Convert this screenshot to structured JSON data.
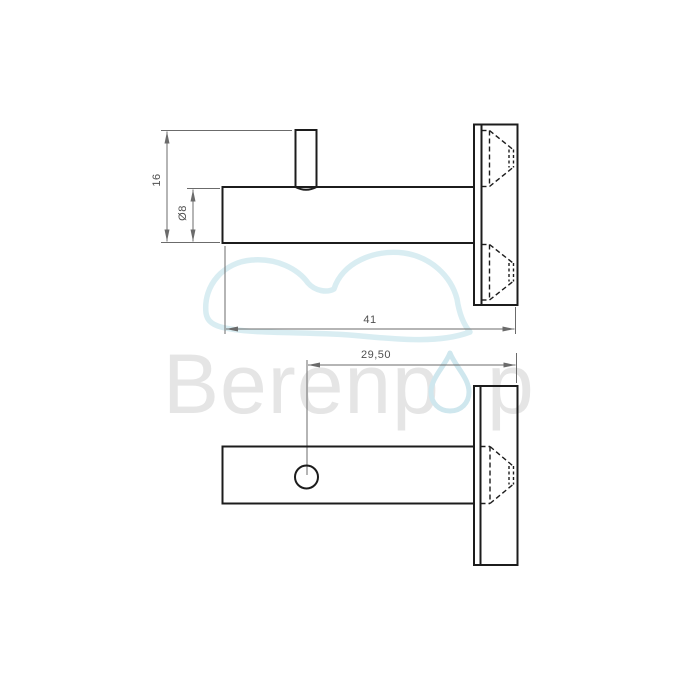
{
  "drawing": {
    "type": "technical-dimension-drawing",
    "colors": {
      "background": "#ffffff",
      "edge_line": "#1c1c1c",
      "dimension_line": "#6b6b6b",
      "dimension_text": "#4f4f4f",
      "watermark_text": "#e5e5e5",
      "logo_cloud": "#d9edf2",
      "logo_droplet": "#cfe7ee"
    },
    "side_view": {
      "name": "side view (hook with mounting plate)",
      "dim_overall_height": "16",
      "dim_bar_diameter": "Ø8",
      "dim_overall_length": "41"
    },
    "plan_view": {
      "name": "plan view (bar with set-screw hole and wall plate)",
      "dim_hole_offset": "29,50"
    }
  },
  "watermark": {
    "text_left": "Berenp",
    "text_right": "p"
  }
}
